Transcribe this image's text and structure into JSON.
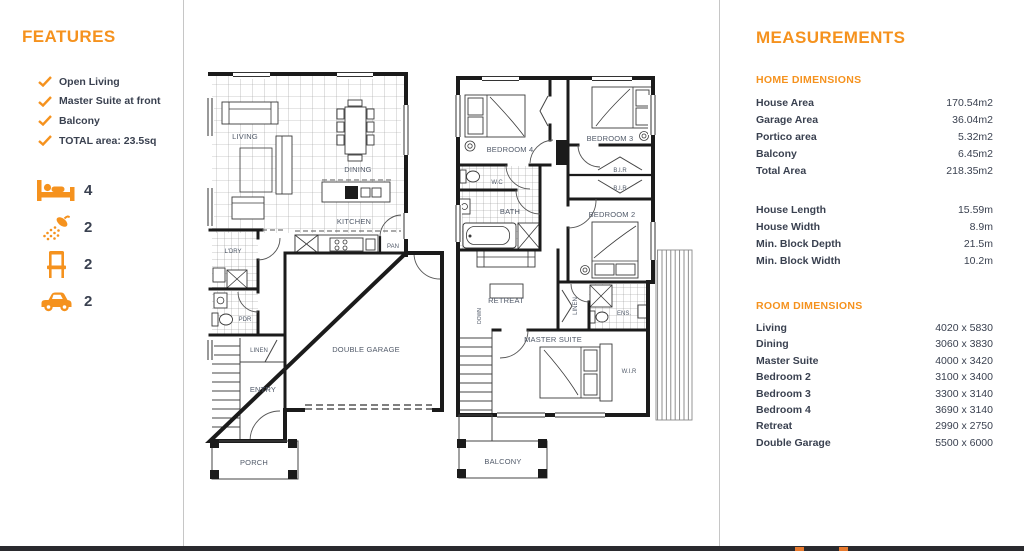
{
  "colors": {
    "accent": "#F5921E",
    "body_text": "#3A4150",
    "plan_label": "#515A69",
    "footer_bar": "#2A2A2E",
    "footer_accent": "#E87A2E",
    "divider": "#C6C6C6"
  },
  "features": {
    "heading": "FEATURES",
    "checklist": [
      "Open Living",
      "Master Suite at front",
      "Balcony",
      "TOTAL area: 23.5sq"
    ],
    "stats": [
      {
        "icon": "bed-icon",
        "value": "4"
      },
      {
        "icon": "shower-icon",
        "value": "2"
      },
      {
        "icon": "chair-icon",
        "value": "2"
      },
      {
        "icon": "car-icon",
        "value": "2"
      }
    ]
  },
  "measurements": {
    "heading": "MEASUREMENTS",
    "home": {
      "heading": "HOME DIMENSIONS",
      "areas": [
        {
          "label": "House Area",
          "value": "170.54m2"
        },
        {
          "label": "Garage Area",
          "value": "36.04m2"
        },
        {
          "label": "Portico area",
          "value": "5.32m2"
        },
        {
          "label": "Balcony",
          "value": "6.45m2"
        },
        {
          "label": "Total Area",
          "value": "218.35m2"
        }
      ],
      "lengths": [
        {
          "label": "House Length",
          "value": "15.59m"
        },
        {
          "label": "House Width",
          "value": "8.9m"
        },
        {
          "label": "Min. Block Depth",
          "value": "21.5m"
        },
        {
          "label": "Min. Block Width",
          "value": "10.2m"
        }
      ]
    },
    "rooms": {
      "heading": "ROOM DIMENSIONS",
      "list": [
        {
          "label": "Living",
          "value": "4020 x 5830"
        },
        {
          "label": "Dining",
          "value": "3060 x 3830"
        },
        {
          "label": "Master Suite",
          "value": "4000 x 3420"
        },
        {
          "label": "Bedroom 2",
          "value": "3100 x 3400"
        },
        {
          "label": "Bedroom 3",
          "value": "3300 x 3140"
        },
        {
          "label": "Bedroom 4",
          "value": "3690 x 3140"
        },
        {
          "label": "Retreat",
          "value": "2990 x 2750"
        },
        {
          "label": "Double Garage",
          "value": "5500 x 6000"
        }
      ]
    }
  },
  "floorplans": {
    "ground_floor": {
      "living": "LIVING",
      "dining": "DINING",
      "kitchen": "KITCHEN",
      "pantry": "PAN",
      "laundry": "L'DRY",
      "powder": "PDR",
      "linen": "LINEN",
      "entry": "ENTRY",
      "double_garage": "DOUBLE GARAGE",
      "porch": "PORCH"
    },
    "upper_floor": {
      "bedroom4": "BEDROOM 4",
      "bedroom3": "BEDROOM 3",
      "bir_1": "B.I.R",
      "bir_2": "B.I.R",
      "wc": "W.C",
      "bath": "BATH",
      "bedroom2": "BEDROOM 2",
      "retreat": "RETREAT",
      "linen": "LINEN",
      "ensuite": "ENS.",
      "master_suite": "MASTER SUITE",
      "wir": "W.I.R",
      "down": "DOWN",
      "balcony": "BALCONY"
    }
  }
}
